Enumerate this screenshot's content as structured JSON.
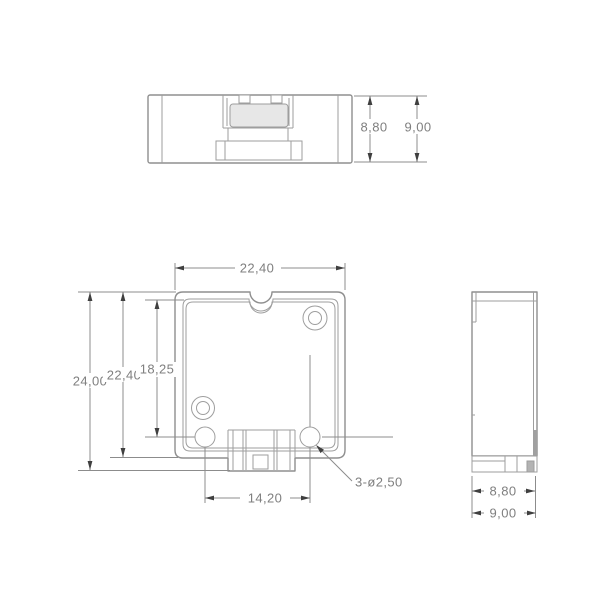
{
  "drawing_type": "multi-view technical drawing of enclosure part",
  "palette": {
    "background": "#ffffff",
    "part_line": "#8f8f8f",
    "thin_line": "#9e9e9e",
    "dimension_line": "#8c8c8c",
    "dimension_text": "#7f7f7f",
    "arrowhead": "#3f3f3f",
    "cavity_fill": "#e7e7e7",
    "insert_fill": "#b3b3b3"
  },
  "views": {
    "top": {
      "dims": {
        "inner_height": "8,80",
        "outer_height": "9,00"
      }
    },
    "front": {
      "dims": {
        "top_width": "22,40",
        "overall_height": "24,00",
        "body_height": "22,40",
        "inner_height": "18,25",
        "hole_spacing": "14,20",
        "holes_note": "3-ø2,50"
      }
    },
    "side": {
      "dims": {
        "inner_depth": "8,80",
        "outer_depth": "9,00"
      }
    }
  }
}
